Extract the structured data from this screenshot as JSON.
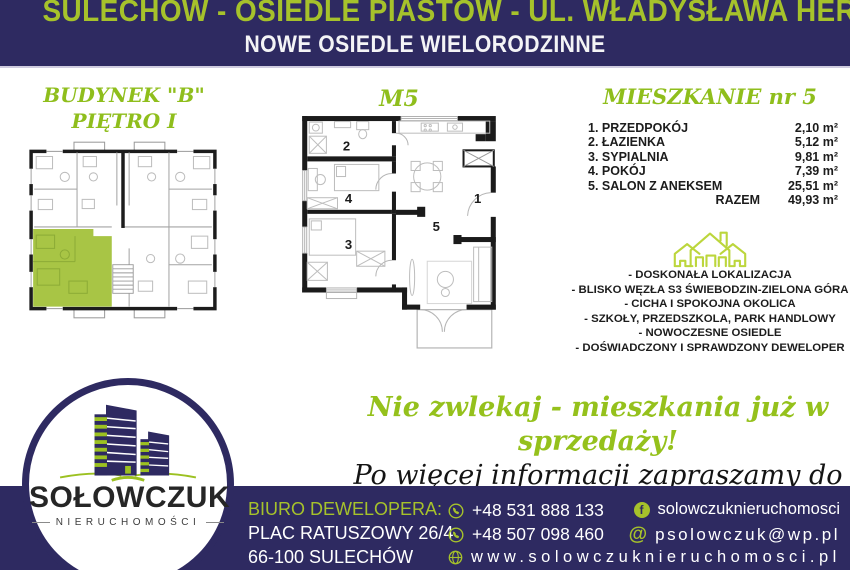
{
  "header": {
    "line1": "SULECHÓW - OSIEDLE PIASTÓW - UL. WŁADYSŁAWA HERMANA",
    "line2": "NOWE OSIEDLE WIELORODZINNE"
  },
  "left_panel": {
    "title_line1": "BUDYNEK \"B\"",
    "title_line2": "PIĘTRO I"
  },
  "center_panel": {
    "title": "M5",
    "room_labels": [
      "1",
      "2",
      "3",
      "4",
      "5"
    ]
  },
  "right_panel": {
    "title": "MIESZKANIE nr 5",
    "rooms": [
      {
        "name": "1. PRZEDPOKÓJ",
        "area": "2,10 m²"
      },
      {
        "name": "2. ŁAZIENKA",
        "area": "5,12 m²"
      },
      {
        "name": "3. SYPIALNIA",
        "area": "9,81 m²"
      },
      {
        "name": "4. POKÓJ",
        "area": "7,39 m²"
      },
      {
        "name": "5. SALON Z ANEKSEM",
        "area": "25,51 m²"
      }
    ],
    "total_label": "RAZEM",
    "total_area": "49,93 m²",
    "features": [
      "- DOSKONAŁA LOKALIZACJA",
      "- BLISKO WĘZŁA S3 ŚWIEBODZIN-ZIELONA GÓRA",
      "- CICHA I SPOKOJNA OKOLICA",
      "- SZKOŁY, PRZEDSZKOLA, PARK HANDLOWY",
      "- NOWOCZESNE OSIEDLE",
      "- DOŚWIADCZONY I SPRAWDZONY DEWELOPER"
    ]
  },
  "promo": {
    "line1": "Nie zwlekaj - mieszkania już w sprzedaży!",
    "line2": "Po więcej informacji zapraszamy do kontaktu!"
  },
  "footer": {
    "logo_name": "SOŁOWCZUK",
    "logo_subtitle": "NIERUCHOMOŚCI",
    "office_label": "BIURO DEWELOPERA:",
    "address_line1": "PLAC RATUSZOWY 26/4",
    "address_line2": "66-100 SULECHÓW",
    "phone1": "+48 531 888 133",
    "phone2": "+48 507 098 460",
    "facebook": "solowczuknieruchomosci",
    "email": "psolowczuk@wp.pl",
    "website": "www.solowczuknieruchomosci.pl",
    "facebook_letter": "f",
    "at_symbol": "@"
  },
  "icons": {
    "phone": "phone-icon",
    "globe": "globe-icon",
    "facebook": "facebook-icon",
    "at": "at-icon",
    "house": "house-icon",
    "logo_buildings": "buildings-icon"
  },
  "colors": {
    "navy": "#2e2a61",
    "green": "#a6c22b",
    "title_green": "#8fbe1c",
    "icon_green": "#bcd63c",
    "highlight_unit_green": "#a8c545"
  }
}
